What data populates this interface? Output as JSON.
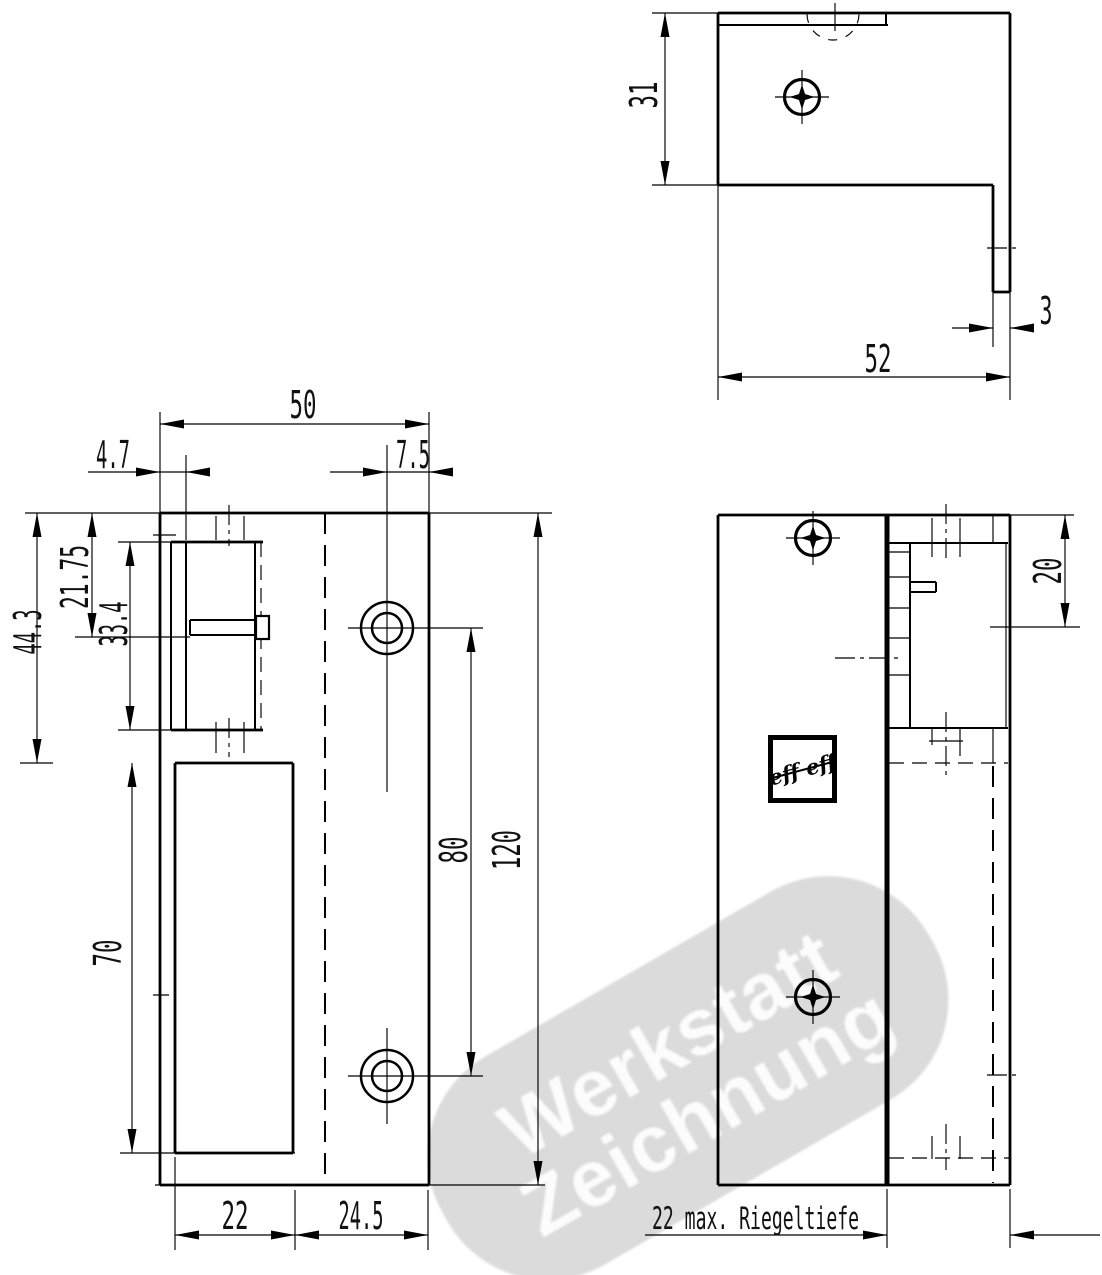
{
  "dims": {
    "top_depth": "31",
    "top_leg": "3",
    "top_width": "52",
    "front_width": "50",
    "front_lip": "4.7",
    "front_hole_edge": "7.5",
    "front_latch": "21.75",
    "front_keeper": "33.4",
    "front_keeper_bottom": "44.3",
    "front_case": "70",
    "front_hole_spacing": "80",
    "front_height": "120",
    "front_case_width": "22",
    "front_right_width": "24.5",
    "side_keeper_top": "20",
    "side_bolt_depth": "22  max. Riegeltiefe"
  },
  "watermark": {
    "line1": "Werkstatt",
    "line2": "Zeichnung"
  },
  "logo": {
    "text": "eff eff"
  },
  "colors": {
    "line": "#000000",
    "watermark_bg": "#d8d8d8",
    "watermark_text": "#ffffff"
  }
}
